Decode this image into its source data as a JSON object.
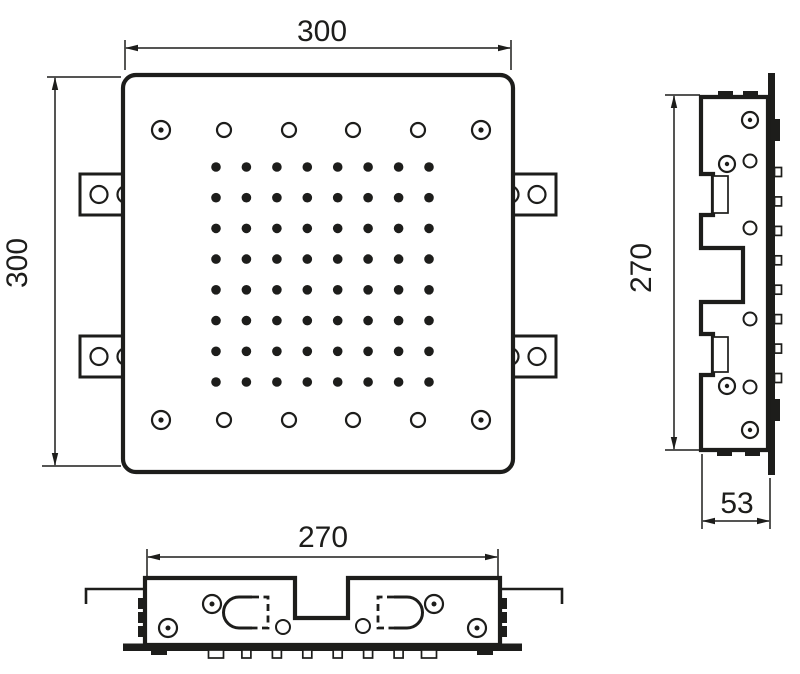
{
  "drawing": {
    "background": "#ffffff",
    "line_color": "#1d1d1b",
    "views": {
      "front": {
        "name": "front view",
        "width_dimension": "300",
        "height_dimension": "300",
        "nozzle_grid": {
          "rows": 8,
          "cols": 8
        },
        "rim_holes_per_row": 6,
        "corner_screws": 4,
        "side_mounting_tabs": 4
      },
      "side": {
        "name": "side profile view",
        "height_dimension": "270",
        "depth_dimension": "53",
        "nozzle_rows": 8
      },
      "bottom": {
        "name": "bottom edge view",
        "width_dimension": "270",
        "nozzle_cols": 8
      }
    }
  }
}
